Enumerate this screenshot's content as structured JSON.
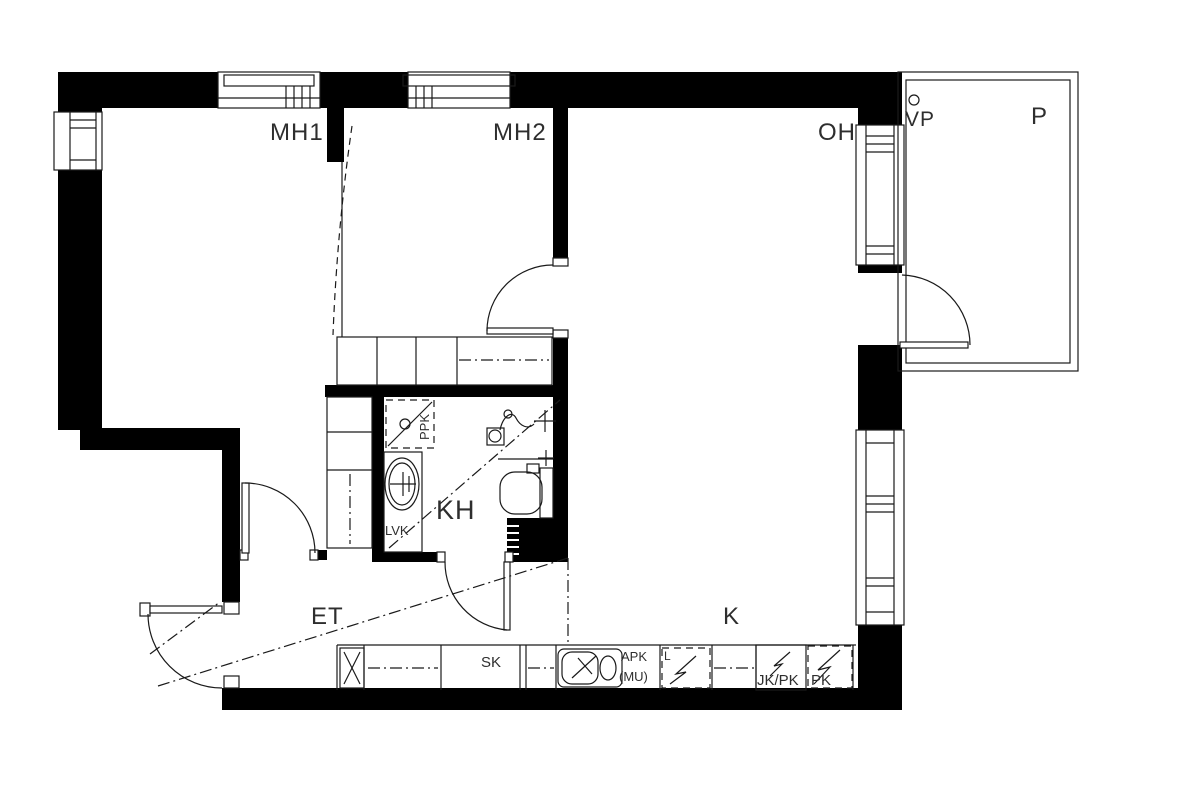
{
  "drawing_title": "apartment-floor-plan",
  "labels": {
    "mh1": "MH1",
    "mh2": "MH2",
    "oh": "OH",
    "vp": "VP",
    "p": "P",
    "kh": "KH",
    "et": "ET",
    "k": "K",
    "lvk": "LVK",
    "ppk": "PPK",
    "sk": "SK",
    "apk": "APK",
    "mu": "(MU)",
    "stove": "L",
    "jkpk": "JK/PK",
    "pk": "PK"
  },
  "colors": {
    "wall": "#000000",
    "line": "#1a1a1a",
    "label": "#2e2e2e",
    "background": "#ffffff"
  }
}
